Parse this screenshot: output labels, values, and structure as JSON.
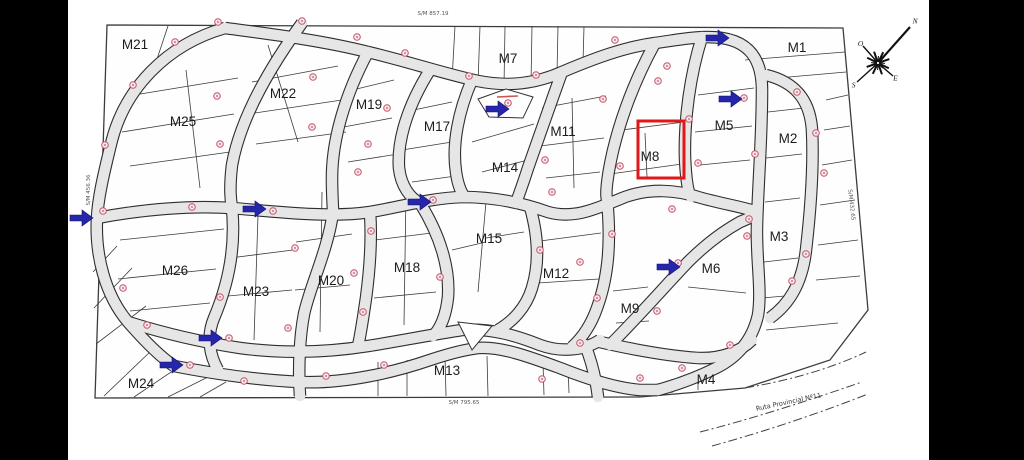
{
  "page": {
    "bg": "#ffffff",
    "bar_color": "#000000"
  },
  "map": {
    "colors": {
      "street_fill": "#e6e6e6",
      "street_edge": "#2e2e2e",
      "lot_line": "#3b3b3b",
      "marker": "#c2556b",
      "marker_fill": "#f8e7ea",
      "arrow": "#2626ab",
      "highlight": "#e21717",
      "boundary": "#3c3c3c",
      "label": "#1c1c1c",
      "measure": "#555555"
    },
    "boundary_points": "107,25 843,28 868,310 830,360 745,388 640,397 95,398",
    "blocks": [
      {
        "label": "M21",
        "x": 135,
        "y": 44
      },
      {
        "label": "M25",
        "x": 183,
        "y": 121
      },
      {
        "label": "M22",
        "x": 283,
        "y": 93
      },
      {
        "label": "M19",
        "x": 369,
        "y": 104
      },
      {
        "label": "M17",
        "x": 437,
        "y": 126
      },
      {
        "label": "M7",
        "x": 508,
        "y": 58
      },
      {
        "label": "M14",
        "x": 505,
        "y": 167
      },
      {
        "label": "M11",
        "x": 563,
        "y": 131
      },
      {
        "label": "M8",
        "x": 650,
        "y": 156
      },
      {
        "label": "M5",
        "x": 724,
        "y": 125
      },
      {
        "label": "M1",
        "x": 797,
        "y": 47
      },
      {
        "label": "M2",
        "x": 788,
        "y": 138
      },
      {
        "label": "M3",
        "x": 779,
        "y": 236
      },
      {
        "label": "M26",
        "x": 175,
        "y": 270
      },
      {
        "label": "M23",
        "x": 256,
        "y": 291
      },
      {
        "label": "M20",
        "x": 331,
        "y": 280
      },
      {
        "label": "M18",
        "x": 407,
        "y": 267
      },
      {
        "label": "M15",
        "x": 489,
        "y": 238
      },
      {
        "label": "M12",
        "x": 556,
        "y": 273
      },
      {
        "label": "M6",
        "x": 711,
        "y": 268
      },
      {
        "label": "M9",
        "x": 630,
        "y": 308
      },
      {
        "label": "M24",
        "x": 141,
        "y": 383
      },
      {
        "label": "M13",
        "x": 447,
        "y": 370
      },
      {
        "label": "M4",
        "x": 706,
        "y": 379
      }
    ],
    "streets": [
      "M 225,28 C 165,45 125,90 112,140 C 102,180 98,200 97,218 C 95,255 105,295 128,322 C 148,345 162,358 174,366",
      "M 225,28 C 270,34 320,40 368,52 C 410,62 445,74 478,81 C 508,87 535,84 562,72 C 595,58 625,47 655,43 C 678,40 700,35 722,38 C 748,42 762,58 762,90 C 762,140 758,185 757,225 C 756,260 762,290 758,315 C 752,342 736,358 716,368 C 696,378 676,385 658,390",
      "M 97,218 C 140,210 185,205 232,208 C 280,212 330,218 370,212 C 400,207 430,198 463,197 C 492,197 520,202 548,212 C 575,220 600,207 625,197 C 650,188 676,190 698,197 C 722,204 744,207 757,212",
      "M 128,322 C 160,332 200,342 240,348 C 285,354 330,352 368,346 C 400,341 435,334 462,330 C 490,328 515,335 540,345 C 562,353 585,350 600,340",
      "M 174,366 C 215,374 255,380 300,382 C 345,384 395,372 430,360 C 448,354 462,350 478,348 C 500,346 530,357 560,368 C 585,378 615,388 640,390 C 648,390 654,390 658,390",
      "M 302,23 C 268,70 240,120 232,165 C 229,190 231,202 232,208 C 236,248 228,285 214,318 C 206,337 210,356 218,370",
      "M 368,52 C 345,95 332,140 332,178 C 332,196 333,206 333,212 C 328,250 310,286 304,314 C 300,335 298,365 300,396",
      "M 370,212 C 372,240 370,268 366,298 C 363,318 361,333 358,346",
      "M 430,70 C 408,105 397,140 399,168 C 401,186 410,198 420,203 C 440,235 450,268 448,297 C 446,316 440,329 433,336",
      "M 472,80 C 458,112 452,145 456,172 C 458,186 462,194 465,197",
      "M 530,207 C 538,235 540,262 532,288 C 526,308 512,322 498,330",
      "M 562,72 C 550,105 538,140 528,168 C 523,184 518,197 516,203",
      "M 655,43 C 632,85 616,130 609,170 C 606,188 606,196 607,199 C 611,240 609,275 597,308 C 591,325 582,338 572,347",
      "M 585,345 C 592,362 596,380 598,397",
      "M 702,37 C 690,75 684,120 685,158 C 686,180 688,192 691,197",
      "M 610,345 C 640,315 666,285 688,262 C 705,245 722,232 740,222 C 750,218 755,215 757,213",
      "M 766,75 C 795,82 810,100 812,130 C 814,170 810,215 806,250 C 802,285 788,305 770,318",
      "M 600,342 C 635,350 668,356 698,358 C 720,359 740,352 752,340"
    ],
    "lot_lines": [
      [
        455,
        26,
        452,
        80
      ],
      [
        480,
        26,
        478,
        84
      ],
      [
        505,
        26,
        504,
        86
      ],
      [
        532,
        26,
        531,
        84
      ],
      [
        558,
        26,
        557,
        74
      ],
      [
        584,
        27,
        583,
        62
      ],
      [
        168,
        26,
        150,
        80
      ],
      [
        186,
        70,
        200,
        188
      ],
      [
        128,
        96,
        238,
        78
      ],
      [
        122,
        132,
        234,
        114
      ],
      [
        130,
        166,
        230,
        152
      ],
      [
        268,
        45,
        298,
        142
      ],
      [
        252,
        82,
        338,
        66
      ],
      [
        248,
        114,
        342,
        100
      ],
      [
        256,
        144,
        346,
        132
      ],
      [
        344,
        92,
        394,
        80
      ],
      [
        338,
        128,
        392,
        118
      ],
      [
        348,
        162,
        398,
        154
      ],
      [
        404,
        112,
        452,
        102
      ],
      [
        402,
        150,
        452,
        142
      ],
      [
        412,
        182,
        456,
        176
      ],
      [
        472,
        142,
        534,
        124
      ],
      [
        482,
        172,
        528,
        160
      ],
      [
        572,
        98,
        574,
        188
      ],
      [
        542,
        108,
        606,
        96
      ],
      [
        540,
        146,
        604,
        138
      ],
      [
        546,
        178,
        600,
        172
      ],
      [
        614,
        131,
        684,
        122
      ],
      [
        645,
        133,
        647,
        177
      ],
      [
        610,
        174,
        682,
        164
      ],
      [
        698,
        95,
        754,
        88
      ],
      [
        695,
        132,
        752,
        126
      ],
      [
        700,
        165,
        750,
        160
      ],
      [
        745,
        60,
        845,
        52
      ],
      [
        755,
        80,
        846,
        72
      ],
      [
        768,
        112,
        804,
        108
      ],
      [
        766,
        158,
        802,
        154
      ],
      [
        765,
        202,
        800,
        198
      ],
      [
        764,
        262,
        798,
        258
      ],
      [
        762,
        298,
        796,
        295
      ],
      [
        826,
        100,
        848,
        95
      ],
      [
        824,
        130,
        850,
        126
      ],
      [
        822,
        165,
        852,
        160
      ],
      [
        820,
        205,
        855,
        200
      ],
      [
        818,
        245,
        858,
        240
      ],
      [
        816,
        280,
        860,
        276
      ],
      [
        120,
        240,
        224,
        229
      ],
      [
        118,
        279,
        216,
        269
      ],
      [
        130,
        311,
        210,
        303
      ],
      [
        258,
        215,
        254,
        340
      ],
      [
        230,
        258,
        293,
        250
      ],
      [
        228,
        296,
        292,
        290
      ],
      [
        322,
        192,
        320,
        332
      ],
      [
        296,
        242,
        352,
        234
      ],
      [
        295,
        290,
        350,
        285
      ],
      [
        406,
        192,
        404,
        325
      ],
      [
        375,
        240,
        440,
        232
      ],
      [
        374,
        298,
        436,
        292
      ],
      [
        486,
        202,
        478,
        292
      ],
      [
        452,
        250,
        486,
        242
      ],
      [
        486,
        238,
        524,
        232
      ],
      [
        540,
        241,
        601,
        233
      ],
      [
        538,
        283,
        599,
        279
      ],
      [
        688,
        287,
        746,
        293
      ],
      [
        613,
        291,
        648,
        287
      ],
      [
        616,
        323,
        649,
        321
      ],
      [
        378,
        362,
        378,
        396
      ],
      [
        407,
        360,
        407,
        396
      ],
      [
        445,
        356,
        446,
        396
      ],
      [
        487,
        356,
        488,
        396
      ],
      [
        543,
        362,
        544,
        395
      ],
      [
        568,
        366,
        569,
        393
      ],
      [
        672,
        379,
        672,
        393
      ],
      [
        698,
        375,
        698,
        390
      ],
      [
        104,
        396,
        152,
        350
      ],
      [
        134,
        397,
        186,
        362
      ],
      [
        168,
        397,
        214,
        374
      ],
      [
        200,
        397,
        226,
        382
      ],
      [
        93,
        272,
        117,
        246
      ],
      [
        94,
        308,
        132,
        268
      ],
      [
        96,
        344,
        146,
        306
      ],
      [
        766,
        330,
        838,
        323
      ]
    ],
    "markers": [
      [
        218,
        22
      ],
      [
        302,
        21
      ],
      [
        357,
        37
      ],
      [
        405,
        53
      ],
      [
        175,
        42
      ],
      [
        133,
        85
      ],
      [
        313,
        77
      ],
      [
        217,
        96
      ],
      [
        387,
        108
      ],
      [
        312,
        127
      ],
      [
        368,
        144
      ],
      [
        220,
        144
      ],
      [
        469,
        76
      ],
      [
        105,
        145
      ],
      [
        358,
        172
      ],
      [
        103,
        211
      ],
      [
        192,
        207
      ],
      [
        273,
        211
      ],
      [
        433,
        200
      ],
      [
        508,
        103
      ],
      [
        615,
        40
      ],
      [
        667,
        66
      ],
      [
        658,
        81
      ],
      [
        603,
        99
      ],
      [
        536,
        75
      ],
      [
        689,
        119
      ],
      [
        744,
        98
      ],
      [
        797,
        92
      ],
      [
        816,
        133
      ],
      [
        545,
        160
      ],
      [
        620,
        166
      ],
      [
        698,
        163
      ],
      [
        755,
        154
      ],
      [
        552,
        192
      ],
      [
        824,
        173
      ],
      [
        672,
        209
      ],
      [
        749,
        219
      ],
      [
        123,
        288
      ],
      [
        147,
        325
      ],
      [
        220,
        297
      ],
      [
        229,
        338
      ],
      [
        190,
        365
      ],
      [
        295,
        248
      ],
      [
        288,
        328
      ],
      [
        244,
        381
      ],
      [
        326,
        376
      ],
      [
        354,
        273
      ],
      [
        363,
        312
      ],
      [
        384,
        365
      ],
      [
        440,
        277
      ],
      [
        371,
        231
      ],
      [
        540,
        250
      ],
      [
        580,
        262
      ],
      [
        597,
        298
      ],
      [
        580,
        343
      ],
      [
        542,
        379
      ],
      [
        640,
        378
      ],
      [
        657,
        311
      ],
      [
        678,
        263
      ],
      [
        612,
        234
      ],
      [
        747,
        236
      ],
      [
        806,
        254
      ],
      [
        792,
        281
      ],
      [
        730,
        345
      ],
      [
        682,
        368
      ]
    ],
    "arrows": [
      [
        70,
        210
      ],
      [
        243,
        201
      ],
      [
        408,
        194
      ],
      [
        486,
        101
      ],
      [
        706,
        30
      ],
      [
        719,
        91
      ],
      [
        657,
        259
      ],
      [
        199,
        330
      ],
      [
        160,
        357
      ]
    ],
    "highlight": {
      "x": 638,
      "y": 121,
      "w": 46,
      "h": 57
    },
    "landmark": {
      "points": "478,99 506,89 533,97 523,118 489,117",
      "tick": [
        497,
        97,
        518,
        96
      ]
    },
    "island": {
      "points": "458,322 492,326 472,350"
    },
    "compass": {
      "cx": 878,
      "cy": 63,
      "rays": [
        {
          "t": "N",
          "x2": 910,
          "y2": 27
        },
        {
          "t": "E",
          "x2": 893,
          "y2": 76
        },
        {
          "t": "S",
          "x2": 857,
          "y2": 82
        },
        {
          "t": "O",
          "x2": 863,
          "y2": 46
        }
      ]
    },
    "measures": [
      {
        "t": "S/M 857.19",
        "x": 433,
        "y": 15,
        "r": 0
      },
      {
        "t": "S/M 795.65",
        "x": 464,
        "y": 404,
        "r": 0
      },
      {
        "t": "S/M 456.36",
        "x": 90,
        "y": 190,
        "r": -90
      },
      {
        "t": "S/M 432.65",
        "x": 850,
        "y": 205,
        "r": 84
      }
    ],
    "road_label": {
      "t": "Ruta Provincial Nº11",
      "x": 789,
      "y": 404,
      "r": -12
    },
    "ruta_lines": [
      "M 700,432 C 755,418 810,400 862,382",
      "M 712,446 C 770,430 822,412 868,394",
      "M 745,388 C 792,380 832,368 866,352"
    ]
  }
}
